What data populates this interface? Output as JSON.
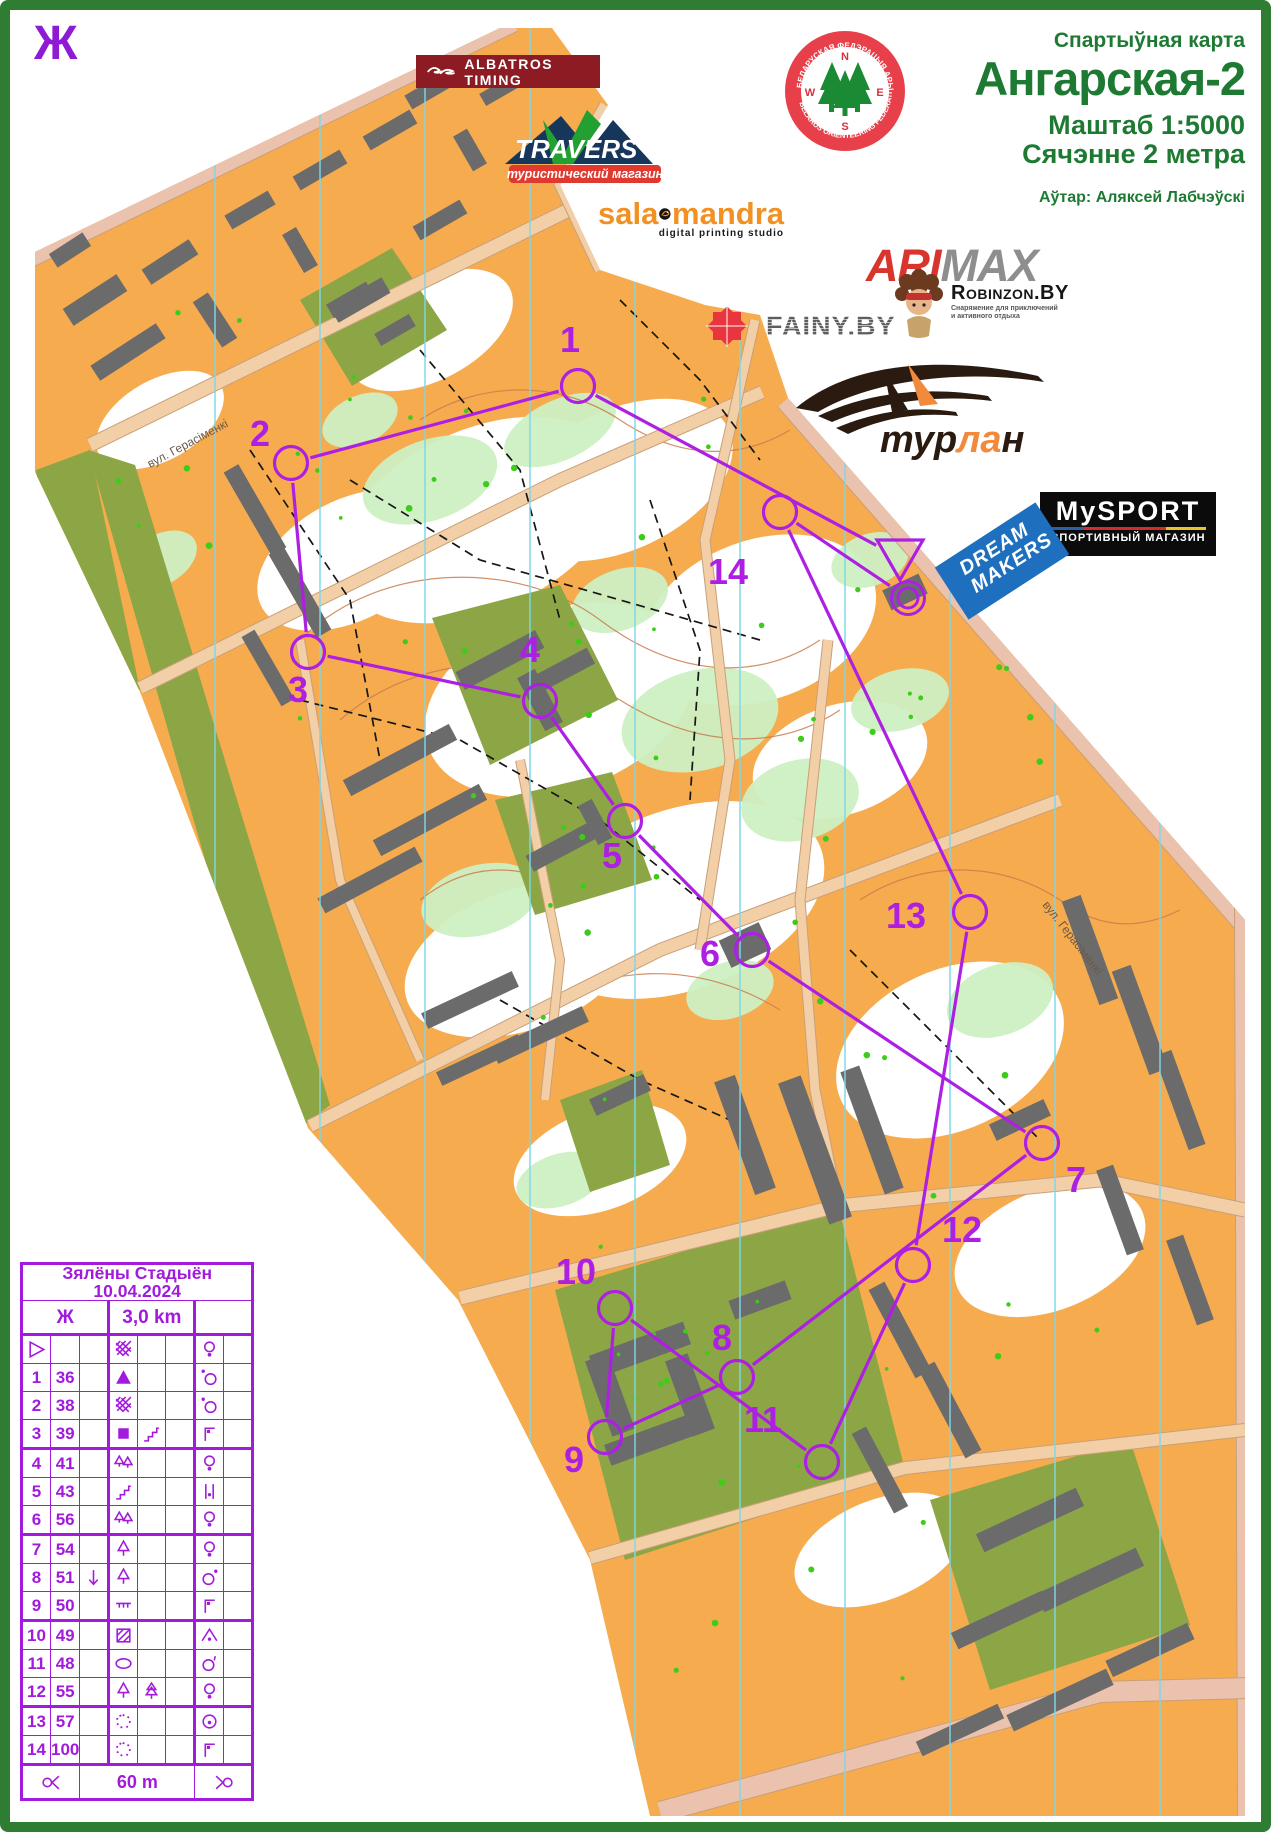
{
  "corner_mark": "Ж",
  "header": {
    "kicker": "Спартыўная карта",
    "title": "Ангарская-2",
    "scale": "Маштаб 1:5000",
    "contour": "Сячэнне 2 метра",
    "author": "Аўтар: Аляксей Лабчэўскі",
    "color": "#1E7A33"
  },
  "sponsors": {
    "albatros": {
      "label": "ALBATROS  TIMING"
    },
    "travers": {
      "label": "TRAVERS",
      "tagline": "туристический магазин"
    },
    "salamandra": {
      "left": "sala",
      "right": "mandra",
      "tagline": "digital printing studio"
    },
    "federation": {
      "top_text": "БЕЛАРУСКАЯ ФЕДЭРАЦЫЯ АРЫЕНТАВАННЯ",
      "bottom_text": "BELARUS ORIENTEERING FEDERATION",
      "compass": {
        "n": "N",
        "w": "W",
        "e": "E",
        "s": "S"
      }
    },
    "armax": {
      "part1": "ARI",
      "part2": "MAX"
    },
    "fainy": {
      "label": "FAINY.BY"
    },
    "robinzon": {
      "brand": "Robinzon.BY",
      "tagline1": "Снаряжение для приключений",
      "tagline2": "и активного отдыха"
    },
    "turlan": {
      "part1": "тур",
      "part2": "ла",
      "part3": "н"
    },
    "mysport": {
      "line1": "MySPORT",
      "line2": "СПОРТИВНЫЙ МАГАЗИН"
    },
    "dreammakers": {
      "line1": "DREAM",
      "line2": "MAKERS"
    }
  },
  "street_labels": [
    {
      "text": "вул. Герасіменкі",
      "x": 150,
      "y": 468,
      "angle": -28
    },
    {
      "text": "вул. Герасіменкі",
      "x": 1042,
      "y": 905,
      "angle": 52
    }
  ],
  "course": {
    "color": "#AD1FE3",
    "start": {
      "x": 900,
      "y": 558
    },
    "finish": {
      "x": 908,
      "y": 598
    },
    "controls": [
      {
        "n": "1",
        "x": 578,
        "y": 386,
        "lx": 560,
        "ly": 352
      },
      {
        "n": "2",
        "x": 291,
        "y": 463,
        "lx": 250,
        "ly": 446
      },
      {
        "n": "3",
        "x": 308,
        "y": 652,
        "lx": 288,
        "ly": 702
      },
      {
        "n": "4",
        "x": 540,
        "y": 701,
        "lx": 520,
        "ly": 662
      },
      {
        "n": "5",
        "x": 625,
        "y": 821,
        "lx": 602,
        "ly": 868
      },
      {
        "n": "6",
        "x": 752,
        "y": 950,
        "lx": 700,
        "ly": 966
      },
      {
        "n": "7",
        "x": 1042,
        "y": 1143,
        "lx": 1066,
        "ly": 1192
      },
      {
        "n": "8",
        "x": 737,
        "y": 1377,
        "lx": 712,
        "ly": 1350
      },
      {
        "n": "9",
        "x": 605,
        "y": 1437,
        "lx": 564,
        "ly": 1472
      },
      {
        "n": "10",
        "x": 615,
        "y": 1308,
        "lx": 556,
        "ly": 1284
      },
      {
        "n": "11",
        "x": 822,
        "y": 1462,
        "lx": 744,
        "ly": 1432
      },
      {
        "n": "12",
        "x": 913,
        "y": 1265,
        "lx": 942,
        "ly": 1242
      },
      {
        "n": "13",
        "x": 970,
        "y": 912,
        "lx": 886,
        "ly": 928
      },
      {
        "n": "14",
        "x": 780,
        "y": 512,
        "lx": 708,
        "ly": 584
      }
    ]
  },
  "control_card": {
    "color": "#A21BDC",
    "title": "Зялёны Стадыён 10.04.2024",
    "course_class": "Ж",
    "length": "3,0 km",
    "climb": "",
    "finish_text": "60 m",
    "rows": [
      {
        "no": "",
        "code": "",
        "c": "",
        "d": "thicket",
        "e": "",
        "f": "",
        "g": "lamp",
        "start": true
      },
      {
        "no": "1",
        "code": "36",
        "c": "",
        "d": "boulder",
        "e": "",
        "f": "",
        "g": "circle-dot-nw"
      },
      {
        "no": "2",
        "code": "38",
        "c": "",
        "d": "thicket",
        "e": "",
        "f": "",
        "g": "circle-dot-nw"
      },
      {
        "no": "3",
        "code": "39",
        "c": "",
        "d": "building",
        "e": "stairway",
        "f": "",
        "g": "flag-corner"
      },
      {
        "no": "4",
        "code": "41",
        "c": "",
        "d": "two-trees",
        "e": "",
        "f": "",
        "g": "lamp"
      },
      {
        "no": "5",
        "code": "43",
        "c": "",
        "d": "stairway",
        "e": "",
        "f": "",
        "g": "between"
      },
      {
        "no": "6",
        "code": "56",
        "c": "",
        "d": "two-trees",
        "e": "",
        "f": "",
        "g": "lamp"
      },
      {
        "no": "7",
        "code": "54",
        "c": "",
        "d": "tree",
        "e": "",
        "f": "",
        "g": "lamp"
      },
      {
        "no": "8",
        "code": "51",
        "c": "arrow-down",
        "d": "tree",
        "e": "",
        "f": "",
        "g": "circle-dot-ne"
      },
      {
        "no": "9",
        "code": "50",
        "c": "",
        "d": "fence",
        "e": "",
        "f": "",
        "g": "flag-corner"
      },
      {
        "no": "10",
        "code": "49",
        "c": "",
        "d": "paved-area",
        "e": "",
        "f": "",
        "g": "apex-dot"
      },
      {
        "no": "11",
        "code": "48",
        "c": "",
        "d": "copse",
        "e": "",
        "f": "",
        "g": "circle-tick"
      },
      {
        "no": "12",
        "code": "55",
        "c": "",
        "d": "tree",
        "e": "conifer",
        "f": "",
        "g": "lamp"
      },
      {
        "no": "13",
        "code": "57",
        "c": "",
        "d": "clearing",
        "e": "",
        "f": "",
        "g": "circle-center-dot"
      },
      {
        "no": "14",
        "code": "100",
        "c": "",
        "d": "clearing",
        "e": "",
        "f": "",
        "g": "flag-corner"
      }
    ]
  },
  "map_colors": {
    "open_land": "#F6AC4E",
    "forest_white": "#FFFFFF",
    "vegetation": "#CDEFC2",
    "olive": "#8CA646",
    "road": "#F2CFA6",
    "road_edge": "#C99F78",
    "road_major": "#EBC2AD",
    "building": "#6B6B6B",
    "north_line": "#7FD7E8",
    "contour": "#C97C4C",
    "path_black": "#161616",
    "green_dot": "#3ECC1B",
    "frame": "#2E7D32"
  }
}
